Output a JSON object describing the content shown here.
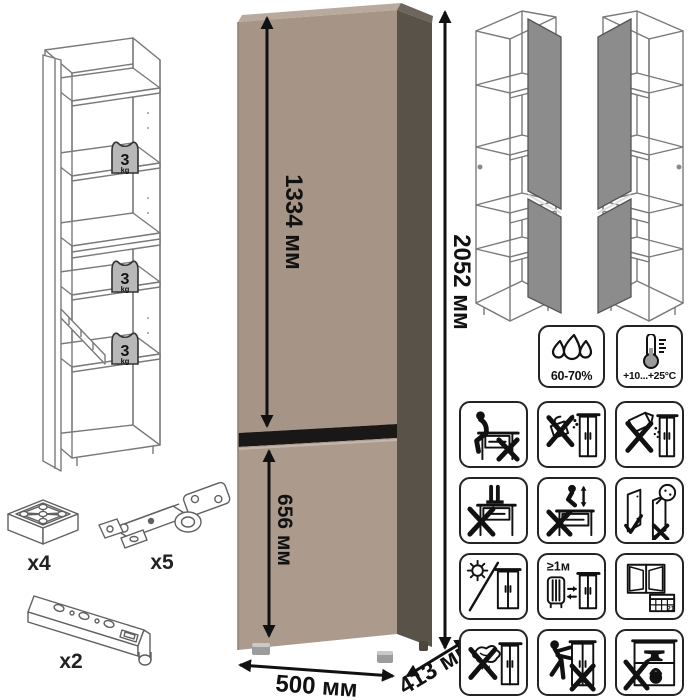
{
  "dimensions": {
    "upper_door_height": "1334 мм",
    "total_height": "2052 мм",
    "lower_door_height": "656 мм",
    "width": "500 мм",
    "depth": "413 мм"
  },
  "shelf_load": {
    "value": "3",
    "unit": "kg"
  },
  "climate": {
    "humidity_label": "60-70%",
    "temperature_label": "+10...+25°C"
  },
  "care": {
    "heat_distance_label": "≥1м",
    "calendar_day": "21",
    "icon_names": [
      "no-sitting",
      "no-pouring-liquids",
      "no-powder-spill",
      "no-standing",
      "no-jumping",
      "door-adjustment",
      "avoid-direct-sunlight",
      "keep-1m-from-heat",
      "regular-ventilation",
      "no-wet-cloth",
      "no-pushing-drag",
      "no-heavy-load"
    ]
  },
  "hardware": {
    "foot_count": "x4",
    "hinge_count": "x5",
    "rail_count": "x2"
  },
  "colors": {
    "front_upper": "#a69486",
    "front_lower": "#ac9a8d",
    "side_panel": "#595249",
    "top_edge": "#b9aa9e",
    "door_gap": "#1a1816",
    "line_drawing": "#7a7a7a",
    "door_fill": "#8c8c8c",
    "dimension_text": "#111111",
    "weight_fill": "#b8b8b8"
  }
}
